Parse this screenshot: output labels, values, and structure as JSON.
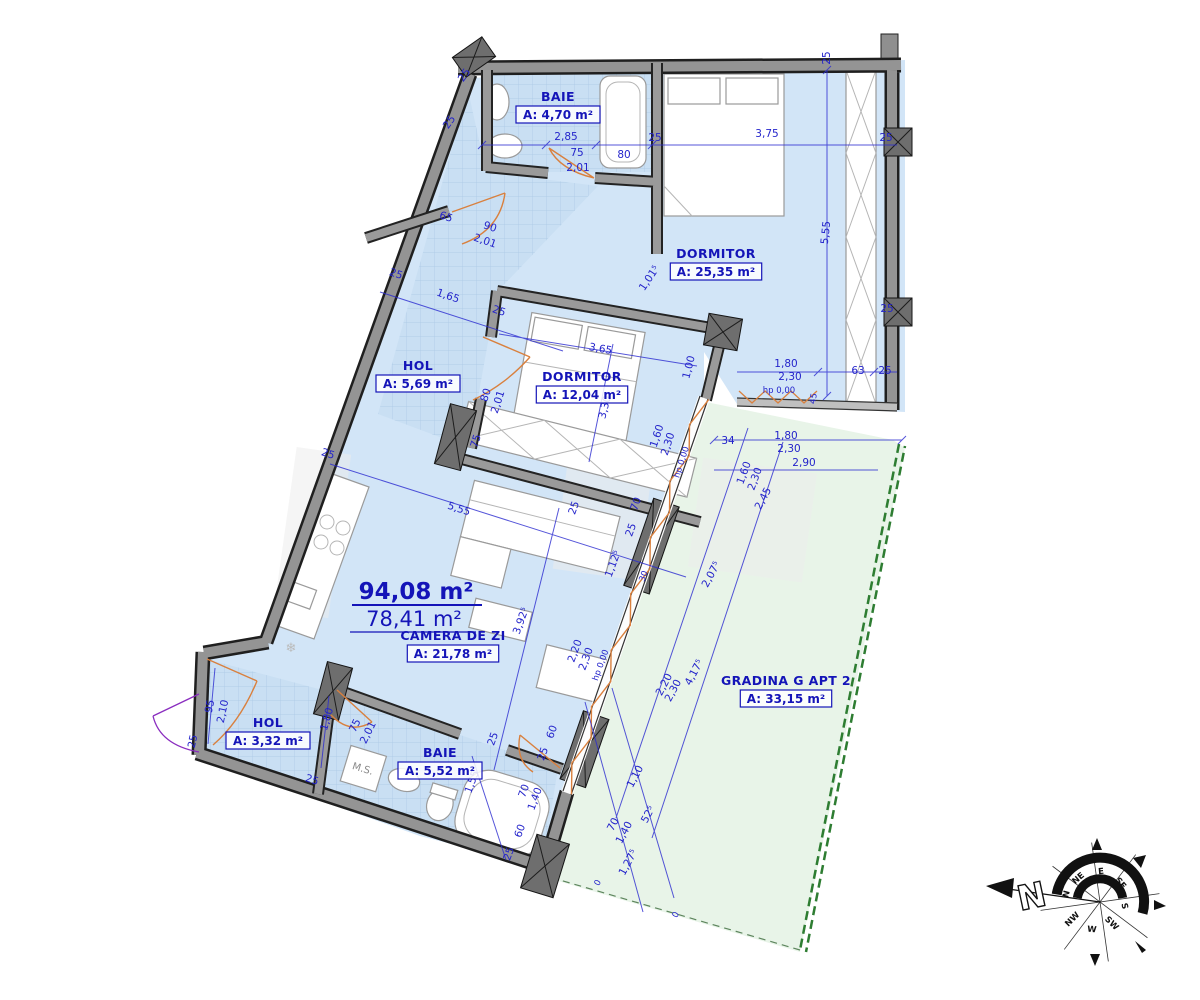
{
  "summary": {
    "total": "94,08 m²",
    "useful": "78,41 m²"
  },
  "annotations": {
    "ms": "M.S."
  },
  "compass": {
    "labels": {
      "n": "N",
      "ne": "NE",
      "e": "E",
      "se": "SE",
      "s": "S",
      "sw": "SW",
      "w": "W",
      "nw": "NW"
    },
    "big_n": "N"
  },
  "colors": {
    "room_fill": "#d2e5f7",
    "tile_fill": "#c9dff3",
    "garden_fill": "#e8f4e8",
    "dim_blue": "#2424cb",
    "label_blue": "#1414b8",
    "wall_gray": "#949494",
    "window_orange": "#d9803e",
    "entry_purple": "#8a2dbf",
    "garden_green": "#2e7d32"
  },
  "rooms": [
    {
      "name": "BAIE",
      "area": "A: 4,70 m²",
      "x": 558,
      "y": 101
    },
    {
      "name": "DORMITOR",
      "area": "A: 25,35 m²",
      "x": 716,
      "y": 258
    },
    {
      "name": "HOL",
      "area": "A: 5,69 m²",
      "x": 418,
      "y": 370
    },
    {
      "name": "DORMITOR",
      "area": "A: 12,04 m²",
      "x": 582,
      "y": 381
    },
    {
      "name": "CAMERA DE ZI",
      "area": "A: 21,78 m²",
      "x": 453,
      "y": 640
    },
    {
      "name": "GRADINA G APT 2",
      "area": "A: 33,15 m²",
      "x": 786,
      "y": 685
    },
    {
      "name": "HOL",
      "area": "A: 3,32 m²",
      "x": 268,
      "y": 727
    },
    {
      "name": "BAIE",
      "area": "A: 5,52 m²",
      "x": 440,
      "y": 757
    }
  ],
  "dims": [
    {
      "t": "25",
      "x": 467,
      "y": 77,
      "r": -55
    },
    {
      "t": "25",
      "x": 452,
      "y": 124,
      "r": -55
    },
    {
      "t": "2,85",
      "x": 566,
      "y": 140,
      "r": 0
    },
    {
      "t": "75",
      "x": 577,
      "y": 156,
      "r": 0
    },
    {
      "t": "2,01",
      "x": 578,
      "y": 171,
      "r": 0
    },
    {
      "t": "80",
      "x": 624,
      "y": 158,
      "r": 0
    },
    {
      "t": "25",
      "x": 655,
      "y": 141,
      "r": 0
    },
    {
      "t": "3,75",
      "x": 767,
      "y": 137,
      "r": 0
    },
    {
      "t": "25",
      "x": 830,
      "y": 58,
      "r": -90
    },
    {
      "t": "25",
      "x": 886,
      "y": 141,
      "r": 0
    },
    {
      "t": "5,55",
      "x": 829,
      "y": 233,
      "r": -84
    },
    {
      "t": "25",
      "x": 887,
      "y": 312,
      "r": 0
    },
    {
      "t": "1,01⁵",
      "x": 652,
      "y": 280,
      "r": -56
    },
    {
      "t": "65",
      "x": 445,
      "y": 220,
      "r": 19
    },
    {
      "t": "90",
      "x": 489,
      "y": 230,
      "r": 19
    },
    {
      "t": "2,01",
      "x": 484,
      "y": 244,
      "r": 19
    },
    {
      "t": "25",
      "x": 395,
      "y": 277,
      "r": 19
    },
    {
      "t": "1,65",
      "x": 447,
      "y": 299,
      "r": 19
    },
    {
      "t": "25",
      "x": 498,
      "y": 314,
      "r": 19
    },
    {
      "t": "3,65",
      "x": 600,
      "y": 352,
      "r": 10
    },
    {
      "t": "3,30",
      "x": 608,
      "y": 408,
      "r": -76
    },
    {
      "t": "1,00",
      "x": 692,
      "y": 368,
      "r": -76
    },
    {
      "t": "80",
      "x": 489,
      "y": 396,
      "r": -72
    },
    {
      "t": "2,01",
      "x": 501,
      "y": 403,
      "r": -72
    },
    {
      "t": "75",
      "x": 479,
      "y": 442,
      "r": -72
    },
    {
      "t": "1,60",
      "x": 660,
      "y": 437,
      "r": -72
    },
    {
      "t": "2,30",
      "x": 671,
      "y": 445,
      "r": -72
    },
    {
      "t": "hp 0,00",
      "x": 684,
      "y": 463,
      "r": -72,
      "s": 1
    },
    {
      "t": "1,80",
      "x": 786,
      "y": 367,
      "r": 0
    },
    {
      "t": "2,30",
      "x": 790,
      "y": 380,
      "r": 0
    },
    {
      "t": "hp 0,00",
      "x": 779,
      "y": 393,
      "r": 0,
      "s": 1
    },
    {
      "t": "63",
      "x": 858,
      "y": 374,
      "r": 0
    },
    {
      "t": "25",
      "x": 885,
      "y": 374,
      "r": 0
    },
    {
      "t": "45",
      "x": 816,
      "y": 399,
      "r": -80,
      "s": 1
    },
    {
      "t": "34",
      "x": 728,
      "y": 444,
      "r": 0
    },
    {
      "t": "1,80",
      "x": 786,
      "y": 439,
      "r": 0
    },
    {
      "t": "2,30",
      "x": 789,
      "y": 452,
      "r": 0
    },
    {
      "t": "2,90",
      "x": 804,
      "y": 466,
      "r": 0
    },
    {
      "t": "1,60",
      "x": 747,
      "y": 474,
      "r": -70
    },
    {
      "t": "2,30",
      "x": 758,
      "y": 480,
      "r": -70
    },
    {
      "t": "2,45",
      "x": 766,
      "y": 500,
      "r": -62
    },
    {
      "t": "2,07⁵",
      "x": 714,
      "y": 576,
      "r": -62
    },
    {
      "t": "4,17⁵",
      "x": 697,
      "y": 674,
      "r": -62
    },
    {
      "t": "2,20",
      "x": 667,
      "y": 686,
      "r": -62
    },
    {
      "t": "2,30",
      "x": 676,
      "y": 692,
      "r": -62
    },
    {
      "t": "25",
      "x": 577,
      "y": 509,
      "r": -70
    },
    {
      "t": "70",
      "x": 639,
      "y": 505,
      "r": -70
    },
    {
      "t": "25",
      "x": 634,
      "y": 531,
      "r": -70
    },
    {
      "t": "1,12⁵",
      "x": 616,
      "y": 565,
      "r": -70
    },
    {
      "t": "30",
      "x": 646,
      "y": 577,
      "r": -70,
      "s": 1
    },
    {
      "t": "2,20",
      "x": 578,
      "y": 652,
      "r": -70
    },
    {
      "t": "2,30",
      "x": 589,
      "y": 660,
      "r": -70
    },
    {
      "t": "hp 0,00",
      "x": 603,
      "y": 666,
      "r": -70,
      "s": 1
    },
    {
      "t": "5,55",
      "x": 458,
      "y": 512,
      "r": 18
    },
    {
      "t": "3,92⁵",
      "x": 524,
      "y": 622,
      "r": -70
    },
    {
      "t": "1,10",
      "x": 638,
      "y": 778,
      "r": -62
    },
    {
      "t": "52⁵",
      "x": 651,
      "y": 816,
      "r": -62
    },
    {
      "t": "70",
      "x": 616,
      "y": 826,
      "r": -62
    },
    {
      "t": "1,40",
      "x": 627,
      "y": 834,
      "r": -62
    },
    {
      "t": "1,27⁵",
      "x": 631,
      "y": 864,
      "r": -62
    },
    {
      "t": "0",
      "x": 600,
      "y": 884,
      "r": -62,
      "s": 1
    },
    {
      "t": "0",
      "x": 678,
      "y": 916,
      "r": -62,
      "s": 1
    },
    {
      "t": "60",
      "x": 555,
      "y": 733,
      "r": -70
    },
    {
      "t": "25",
      "x": 546,
      "y": 755,
      "r": -70
    },
    {
      "t": "70",
      "x": 527,
      "y": 792,
      "r": -70
    },
    {
      "t": "1,40",
      "x": 538,
      "y": 800,
      "r": -70
    },
    {
      "t": "1,55",
      "x": 475,
      "y": 783,
      "r": -70
    },
    {
      "t": "60",
      "x": 523,
      "y": 832,
      "r": -70
    },
    {
      "t": "25",
      "x": 512,
      "y": 855,
      "r": -70
    },
    {
      "t": "25",
      "x": 496,
      "y": 740,
      "r": -70
    },
    {
      "t": "95",
      "x": 213,
      "y": 707,
      "r": -78
    },
    {
      "t": "2,10",
      "x": 226,
      "y": 712,
      "r": -78
    },
    {
      "t": "1,80",
      "x": 330,
      "y": 720,
      "r": -74
    },
    {
      "t": "75",
      "x": 358,
      "y": 727,
      "r": -64
    },
    {
      "t": "2,01",
      "x": 371,
      "y": 734,
      "r": -64
    },
    {
      "t": "25",
      "x": 327,
      "y": 457,
      "r": 18
    },
    {
      "t": "25",
      "x": 196,
      "y": 742,
      "r": -78
    },
    {
      "t": "25",
      "x": 311,
      "y": 783,
      "r": 18
    }
  ]
}
